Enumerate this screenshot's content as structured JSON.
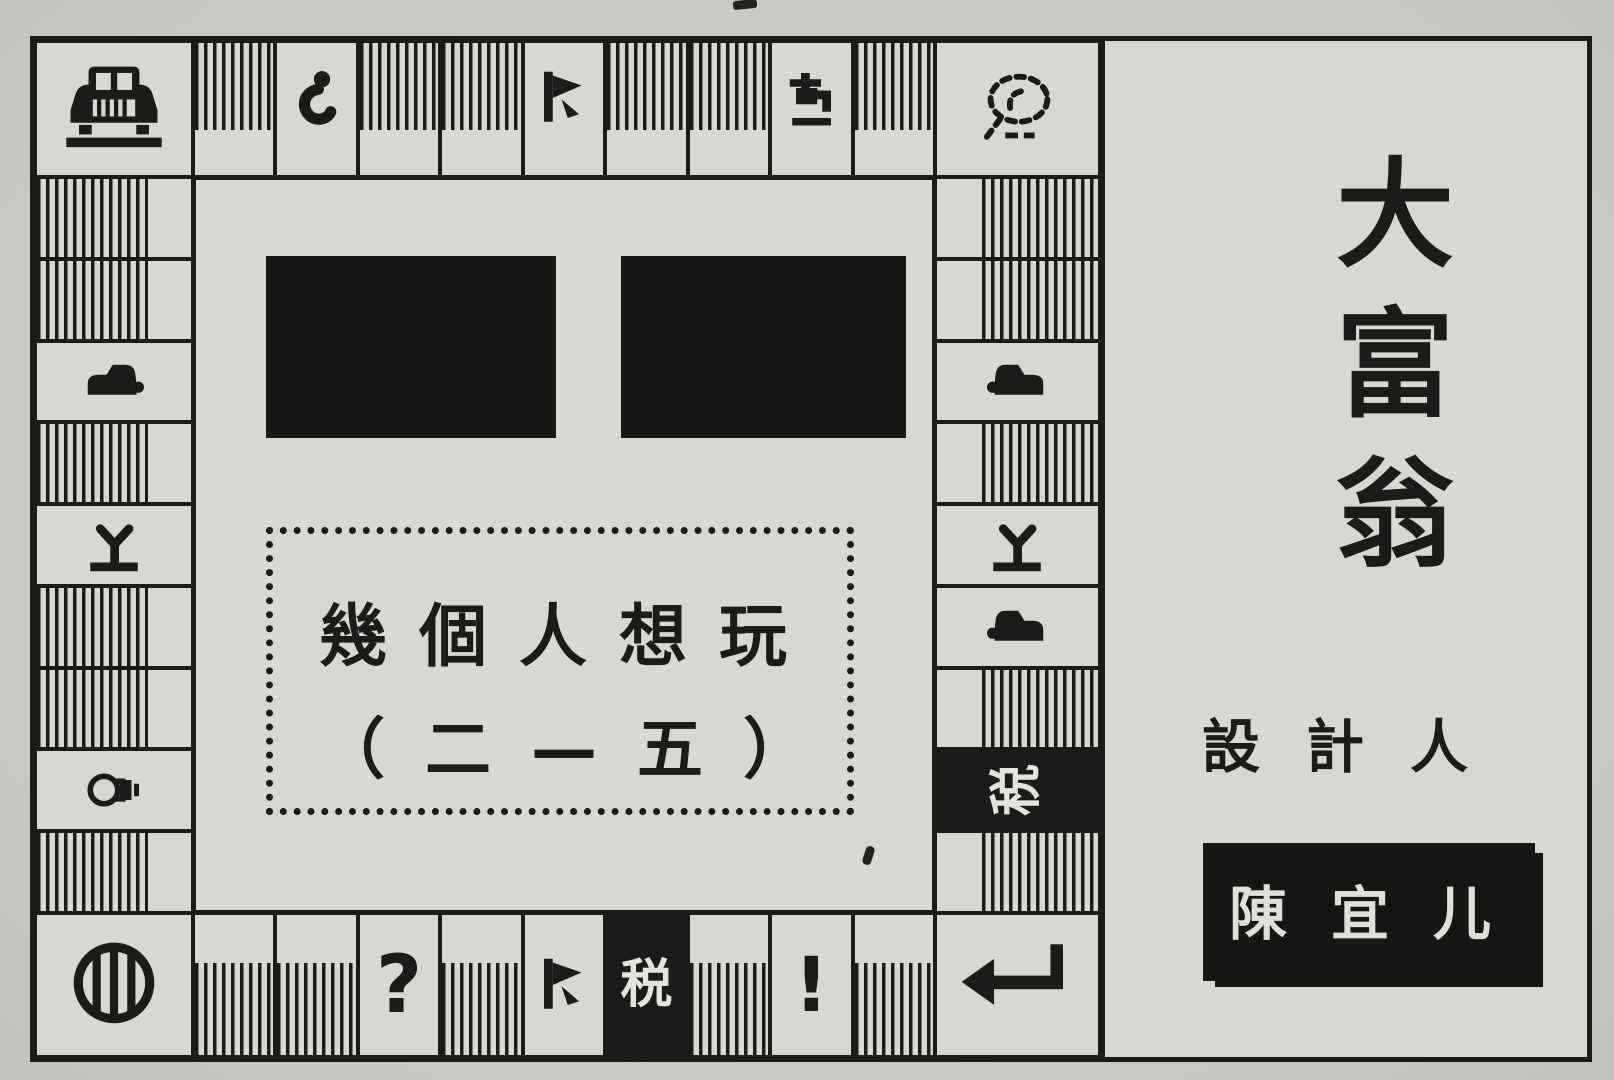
{
  "colors": {
    "ink": "#1b1b19",
    "paper": "#d8d7d2",
    "page_bg": "#c9c8c4",
    "invert_text": "#e4e4df"
  },
  "board": {
    "corners": {
      "top_left": "car-front",
      "top_right": "bird",
      "bottom_left": "barrel",
      "bottom_right": "return-arrow"
    },
    "top": [
      "stripe",
      "hook",
      "stripe",
      "stripe",
      "flag",
      "stripe",
      "stripe",
      "tap",
      "stripe"
    ],
    "right": [
      "stripe",
      "stripe",
      "car-right",
      "stripe",
      "plant",
      "car-right",
      "stripe",
      "tax-rotated",
      "stripe"
    ],
    "bottom": [
      "stripe",
      "stripe",
      "question",
      "stripe",
      "flag",
      "tax",
      "stripe",
      "exclaim",
      "stripe"
    ],
    "left": [
      "stripe",
      "stripe",
      "car-left",
      "stripe",
      "plant",
      "stripe",
      "stripe",
      "bulb",
      "stripe"
    ],
    "tax_char": "税",
    "question_char": "?",
    "exclaim_char": "!"
  },
  "dialog": {
    "line1": "幾個人想玩",
    "line2": "（二—五）"
  },
  "panel": {
    "title_chars": [
      "大",
      "富",
      "翁"
    ],
    "designer_label": "設計人",
    "designer_name": "陳宜儿"
  }
}
